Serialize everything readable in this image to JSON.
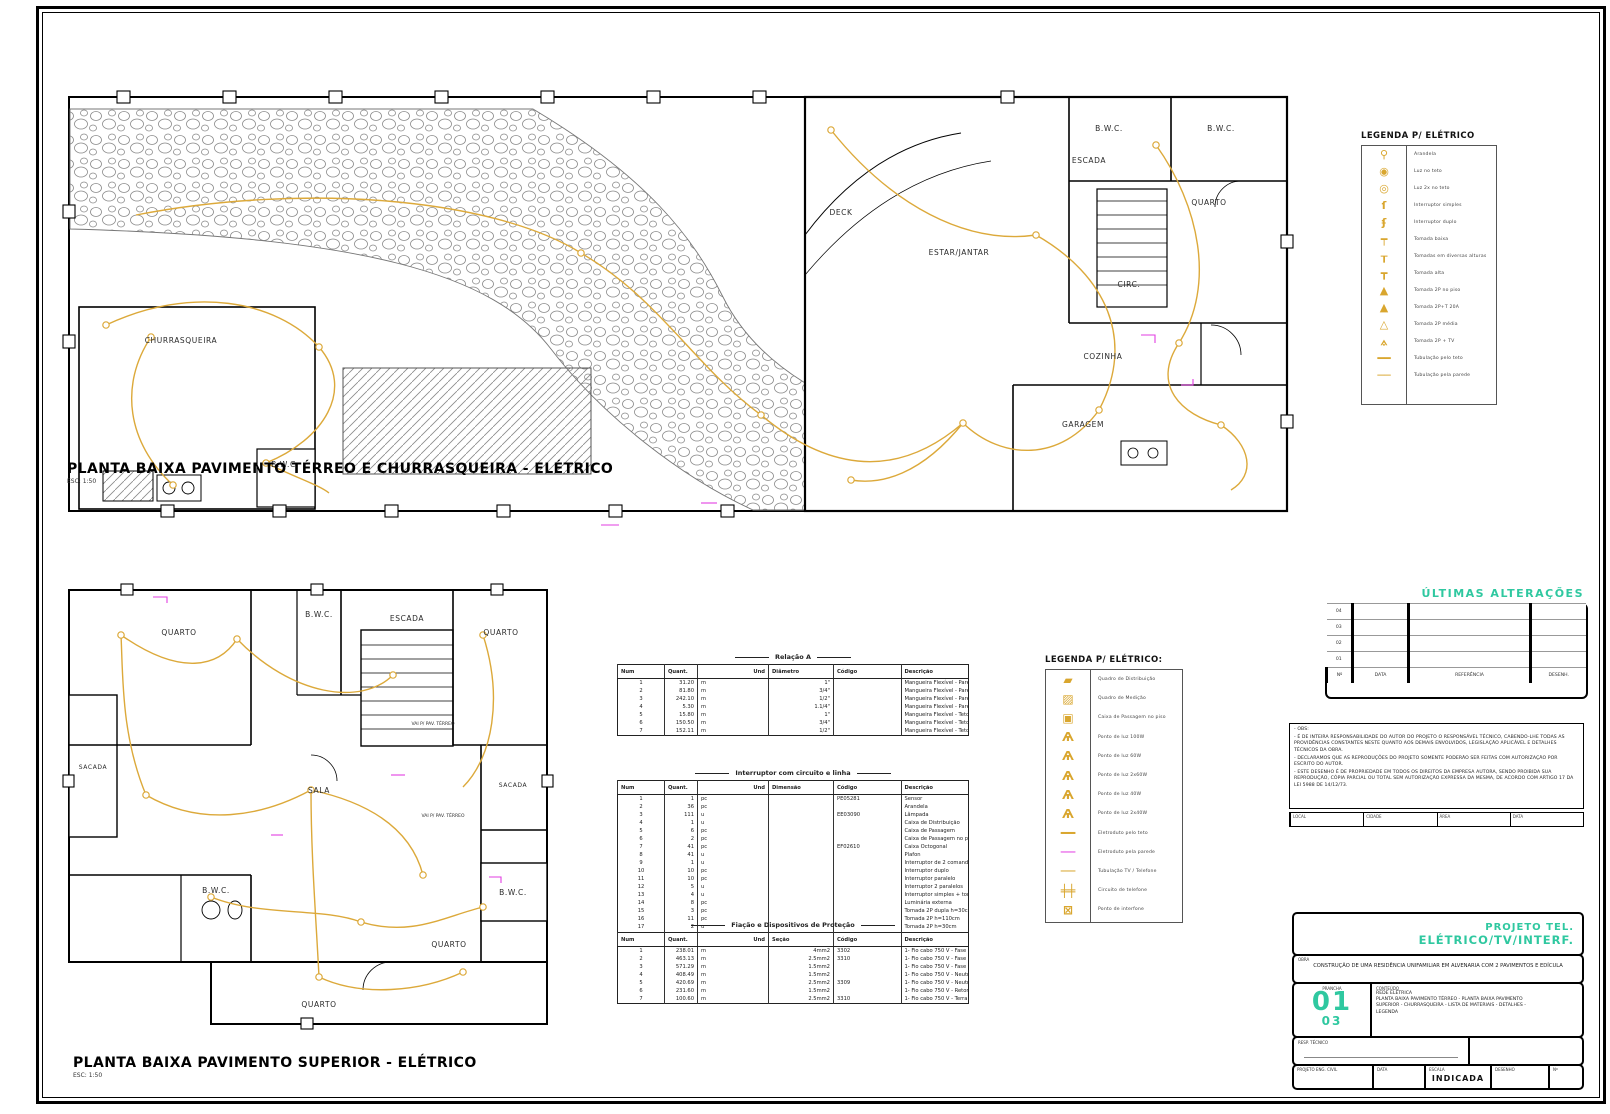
{
  "plan1": {
    "title": "PLANTA BAIXA PAVIMENTO TÉRREO E CHURRASQUEIRA - ELÉTRICO",
    "scale": "ESC: 1:50",
    "rooms": [
      "CHURRASQUEIRA",
      "B.W.C.",
      "DECK",
      "ESTAR/JANTAR",
      "ESCADA",
      "B.W.C.",
      "B.W.C.",
      "QUARTO",
      "CIRC.",
      "COZINHA",
      "GARAGEM"
    ]
  },
  "plan2": {
    "title": "PLANTA BAIXA PAVIMENTO SUPERIOR - ELÉTRICO",
    "scale": "ESC: 1:50",
    "rooms": [
      "QUARTO",
      "B.W.C.",
      "ESCADA",
      "QUARTO",
      "SACADA",
      "SALA",
      "SACADA",
      "B.W.C.",
      "B.W.C.",
      "QUARTO",
      "QUARTO"
    ],
    "callout": "VAI P/ PAV. TÉRREO"
  },
  "legend1": {
    "title": "LEGENDA P/ ELÉTRICO",
    "items": [
      {
        "glyph": "⚲",
        "label": "Arandela"
      },
      {
        "glyph": "◉",
        "label": "Luz no teto"
      },
      {
        "glyph": "◎",
        "label": "Luz 2x no teto"
      },
      {
        "glyph": "ſ",
        "label": "Interruptor simples"
      },
      {
        "glyph": "ʄ",
        "label": "Interruptor duplo"
      },
      {
        "glyph": "┯",
        "label": "Tomada baixa"
      },
      {
        "glyph": "┰",
        "label": "Tomadas em diversas alturas"
      },
      {
        "glyph": "┳",
        "label": "Tomada alta"
      },
      {
        "glyph": "▲",
        "label": "Tomada 2P no piso"
      },
      {
        "glyph": "▲",
        "label": "Tomada 2P+T 20A"
      },
      {
        "glyph": "△",
        "label": "Tomada 2P média"
      },
      {
        "glyph": "⟑",
        "label": "Tomada 2P + TV"
      },
      {
        "glyph": "━━",
        "label": "Tubulação pelo teto"
      },
      {
        "glyph": "──",
        "label": "Tubulação pela parede"
      }
    ]
  },
  "legend2": {
    "title": "LEGENDA P/ ELÉTRICO:",
    "items": [
      {
        "glyph": "▰",
        "label": "Quadro de Distribuição"
      },
      {
        "glyph": "▨",
        "label": "Quadro de Medição"
      },
      {
        "glyph": "▣",
        "label": "Caixa de Passagem no piso"
      },
      {
        "glyph": "Ѧ",
        "label": "Ponto de luz 100W"
      },
      {
        "glyph": "Ѧ",
        "label": "Ponto de luz 60W"
      },
      {
        "glyph": "Ѧ",
        "label": "Ponto de luz 2x60W"
      },
      {
        "glyph": "Ѧ",
        "label": "Ponto de luz 40W"
      },
      {
        "glyph": "Ѧ",
        "label": "Ponto de luz 2x40W"
      },
      {
        "glyph": "━━",
        "label": "Eletroduto pelo teto"
      },
      {
        "glyph": "──",
        "label": "Eletroduto pela parede"
      },
      {
        "glyph": "──",
        "label": "Tubulação TV / Telefone"
      },
      {
        "glyph": "╪╪",
        "label": "Circuito de telefone"
      },
      {
        "glyph": "⊠",
        "label": "Ponto de interfone"
      }
    ]
  },
  "tables": {
    "materials": {
      "title": "Relação A",
      "headers": [
        "Num",
        "Quant.",
        "Und",
        "Diâmetro",
        "Código",
        "Descrição"
      ],
      "rows": [
        [
          "1",
          "31.20",
          "m",
          "1\"",
          "",
          "Mangueira Flexível - Parede"
        ],
        [
          "2",
          "81.80",
          "m",
          "3/4\"",
          "",
          "Mangueira Flexível - Parede"
        ],
        [
          "3",
          "242.10",
          "m",
          "1/2\"",
          "",
          "Mangueira Flexível - Parede"
        ],
        [
          "4",
          "5.30",
          "m",
          "1.1/4\"",
          "",
          "Mangueira Flexível - Parede"
        ],
        [
          "5",
          "15.80",
          "m",
          "1\"",
          "",
          "Mangueira Flexível - Teto"
        ],
        [
          "6",
          "150.50",
          "m",
          "3/4\"",
          "",
          "Mangueira Flexível - Teto"
        ],
        [
          "7",
          "152.11",
          "m",
          "1/2\"",
          "",
          "Mangueira Flexível - Teto"
        ]
      ]
    },
    "devices": {
      "title": "Interruptor com circuito e linha",
      "headers": [
        "Num",
        "Quant.",
        "Und",
        "Dimensão",
        "Código",
        "Descrição"
      ],
      "rows": [
        [
          "1",
          "1",
          "pc",
          "",
          "PE05281",
          "Sensor"
        ],
        [
          "2",
          "36",
          "pc",
          "",
          "",
          "Arandela"
        ],
        [
          "3",
          "111",
          "u",
          "",
          "EE03090",
          "Lâmpada"
        ],
        [
          "4",
          "1",
          "u",
          "",
          "",
          "Caixa de Distribuição"
        ],
        [
          "5",
          "6",
          "pc",
          "",
          "",
          "Caixa de Passagem"
        ],
        [
          "6",
          "2",
          "pc",
          "",
          "",
          "Caixa de Passagem no piso"
        ],
        [
          "7",
          "41",
          "pc",
          "",
          "EF02610",
          "Caixa Octogonal"
        ],
        [
          "8",
          "41",
          "u",
          "",
          "",
          "Plafon"
        ],
        [
          "9",
          "1",
          "u",
          "",
          "",
          "Interruptor de 2 comandos"
        ],
        [
          "10",
          "10",
          "pc",
          "",
          "",
          "Interruptor duplo"
        ],
        [
          "11",
          "10",
          "pc",
          "",
          "",
          "Interruptor paralelo"
        ],
        [
          "12",
          "5",
          "u",
          "",
          "",
          "Interruptor 2 paralelos"
        ],
        [
          "13",
          "4",
          "u",
          "",
          "",
          "Interruptor simples + tomada"
        ],
        [
          "14",
          "8",
          "pc",
          "",
          "",
          "Luminária externa"
        ],
        [
          "15",
          "3",
          "pc",
          "",
          "",
          "Tomada 2P dupla h=30cm"
        ],
        [
          "16",
          "11",
          "pc",
          "",
          "",
          "Tomada 2P h=110cm"
        ],
        [
          "17",
          "2",
          "u",
          "",
          "",
          "Tomada 2P h=30cm"
        ],
        [
          "18",
          "7",
          "u",
          "",
          "",
          "Tomada estanque 2P"
        ]
      ]
    },
    "wiring": {
      "title": "Fiação e Dispositivos de Proteção",
      "headers": [
        "Num",
        "Quant.",
        "Und",
        "Seção",
        "Código",
        "Descrição"
      ],
      "rows": [
        [
          "1",
          "238.01",
          "m",
          "4mm2",
          "3302",
          "1- Fio cabo 750 V - Fase"
        ],
        [
          "2",
          "463.13",
          "m",
          "2.5mm2",
          "3310",
          "1- Fio cabo 750 V - Fase"
        ],
        [
          "3",
          "571.29",
          "m",
          "1.5mm2",
          "",
          "1- Fio cabo 750 V - Fase"
        ],
        [
          "4",
          "408.49",
          "m",
          "1.5mm2",
          "",
          "1- Fio cabo 750 V - Neutro"
        ],
        [
          "5",
          "420.69",
          "m",
          "2.5mm2",
          "3309",
          "1- Fio cabo 750 V - Neutro"
        ],
        [
          "6",
          "231.60",
          "m",
          "1.5mm2",
          "",
          "1- Fio cabo 750 V - Retorno"
        ],
        [
          "7",
          "100.60",
          "m",
          "2.5mm2",
          "3310",
          "1- Fio cabo 750 V - Terra"
        ]
      ]
    }
  },
  "revisions": {
    "title": "ÚLTIMAS ALTERAÇÕES",
    "rows": [
      [
        "04",
        "",
        "",
        ""
      ],
      [
        "03",
        "",
        "",
        ""
      ],
      [
        "02",
        "",
        "",
        ""
      ],
      [
        "01",
        "",
        "",
        ""
      ]
    ],
    "headers": [
      "Nº",
      "DATA",
      "REFERÊNCIA",
      "DESENH."
    ]
  },
  "notes": {
    "lines": [
      "- OBS:",
      "- É DE INTEIRA RESPONSABILIDADE DO AUTOR DO PROJETO O RESPONSÁVEL TÉCNICO, CABENDO-LHE TODAS AS PROVIDÊNCIAS CONSTANTES NESTE QUANTO AOS DEMAIS ENVOLVIDOS, LEGISLAÇÃO APLICÁVEL E DETALHES TÉCNICOS DA OBRA.",
      "- DECLARAMOS QUE AS REPRODUÇÕES DO PROJETO SOMENTE PODERÃO SER FEITAS COM AUTORIZAÇÃO POR ESCRITO DO AUTOR.",
      "- ESTE DESENHO É DE PROPRIEDADE EM TODOS OS DIREITOS DA EMPRESA AUTORA, SENDO PROIBIDA SUA REPRODUÇÃO, CÓPIA PARCIAL OU TOTAL SEM AUTORIZAÇÃO EXPRESSA DA MESMA, DE ACORDO COM ARTIGO 17 DA LEI 5988 DE 14/12/73."
    ]
  },
  "info_strip": {
    "cells": [
      "LOCAL",
      "CIDADE",
      "ÁREA",
      "DATA"
    ]
  },
  "titleblock": {
    "project_line1": "PROJETO TEL.",
    "project_line2": "ELÉTRICO/TV/INTERF.",
    "obra_label": "OBRA",
    "obra_text": "CONSTRUÇÃO DE UMA RESIDÊNCIA UNIFAMILIAR EM ALVENARIA COM 2 PAVIMENTOS E EDÍCULA",
    "prancha_label": "PRANCHA",
    "sheet_number": "01",
    "sheet_total": "03",
    "conteudo_label": "CONTEÚDO",
    "conteudo_lines": [
      "REDE ELÉTRICA",
      "PLANTA BAIXA PAVIMENTO TÉRREO - PLANTA BAIXA PAVIMENTO",
      "SUPERIOR - CHURRASQUEIRA - LISTA DE MATERIAIS - DETALHES -",
      "LEGENDA"
    ],
    "resp_label": "RESP. TÉCNICO",
    "bottom_cells": [
      {
        "label": "PROJETO ENG. CIVIL",
        "value": ""
      },
      {
        "label": "DATA",
        "value": ""
      },
      {
        "label": "ESCALA",
        "value": "INDICADA"
      },
      {
        "label": "DESENHO",
        "value": ""
      },
      {
        "label": "Nº",
        "value": ""
      }
    ]
  }
}
